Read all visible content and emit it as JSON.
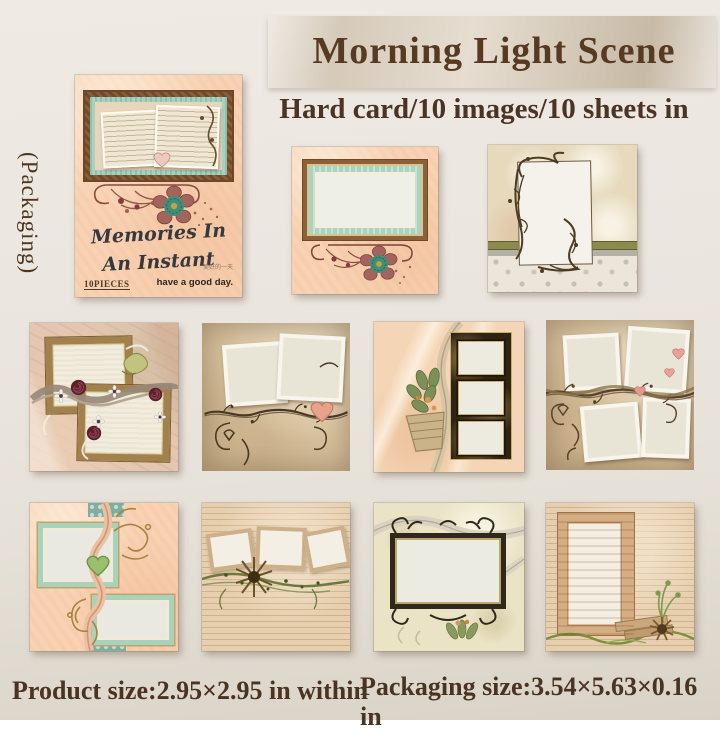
{
  "header": {
    "title": "Morning Light Scene",
    "subtitle": "Hard card/10 images/10 sheets in"
  },
  "packaging": {
    "side_label": "(Packaging)",
    "cover_title_line1": "Memories In",
    "cover_title_line2": "An Instant",
    "pieces_label": "10PIECES",
    "tagline_cn": "美好的一天",
    "tagline_en": "have a good day."
  },
  "footer": {
    "product_size": "Product size:2.95×2.95 in within",
    "packaging_size": "Packaging size:3.54×5.63×0.16 in"
  },
  "samples": [
    {
      "id": "mint-frame-sheet",
      "name": "mint and brown frame sheet with teal flower"
    },
    {
      "id": "twig-frame-sheet",
      "name": "twig photo frame sheet with olive band and lace"
    },
    {
      "id": "gold-frames-sheet",
      "name": "two gold frames sheet with burgundy rosettes and ribbon"
    },
    {
      "id": "polaroid-heart-sheet",
      "name": "two polaroids sheet with branch and pink heart"
    },
    {
      "id": "filmstrip-sheet",
      "name": "triple window dark filmstrip sheet with leaf basket"
    },
    {
      "id": "four-polaroids-sheet",
      "name": "four polaroids sheet with twisted branch and hearts"
    },
    {
      "id": "mint-ribbon-sheet",
      "name": "mint frames sheet with pink ribbon and green heart"
    },
    {
      "id": "three-frames-flower-sheet",
      "name": "three tilted frames sheet with dried flower and vine"
    },
    {
      "id": "iron-frame-sheet",
      "name": "ornate iron frame sheet with flowing ribbons"
    },
    {
      "id": "door-frame-sheet",
      "name": "wooden door frame sheet with dried flower and green ribbon"
    }
  ],
  "colors": {
    "page_background": "#e9e4dc",
    "title_text": "#573a21",
    "body_text": "#4b3424",
    "peach_paper": "#f8d2b2",
    "tan_paper": "#dbc5a1",
    "mint_frame": "#a8d2c0",
    "frame_brown": "#7a5233",
    "burgundy_flower": "#5c1f2c",
    "olive_band": "#8b8b4e"
  }
}
